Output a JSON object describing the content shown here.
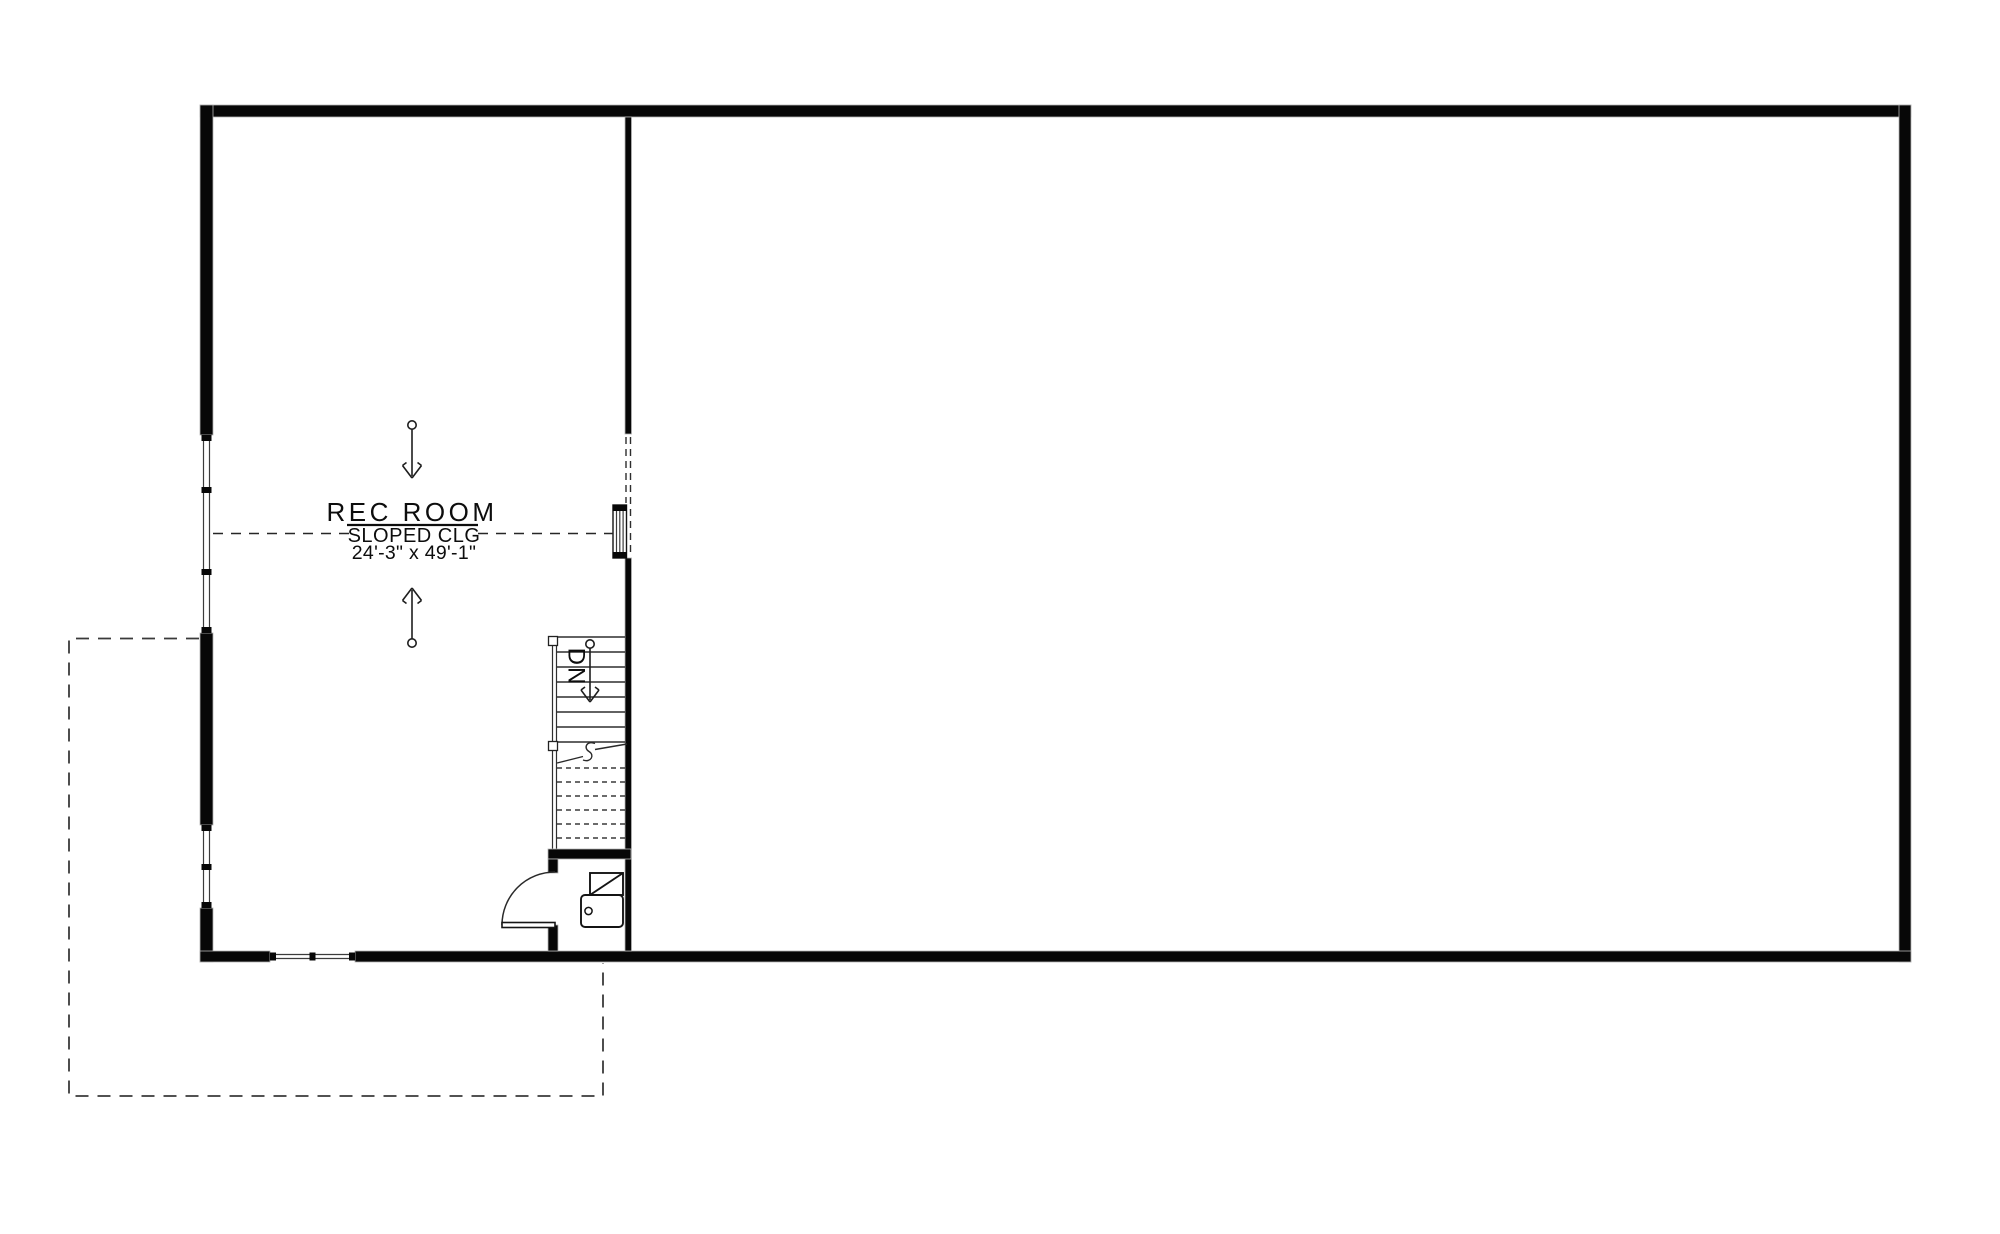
{
  "plan": {
    "labels": {
      "room_name": "REC ROOM",
      "ceiling_note": "SLOPED CLG",
      "room_dimensions": "24'-3\" x 49'-1\"",
      "stair_direction": "DN"
    },
    "colors": {
      "background": "#ffffff",
      "wall": "#070707",
      "line": "#2a2a2a",
      "dashed_outline": "#3a3a3a"
    }
  }
}
